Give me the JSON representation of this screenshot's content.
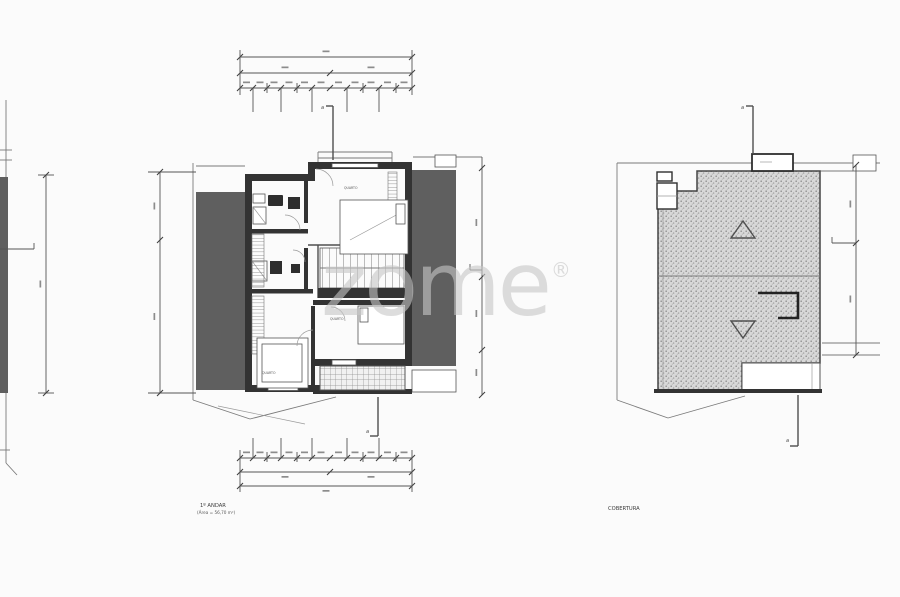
{
  "watermark": {
    "text": "zome",
    "registered": "®",
    "color": "rgba(199,199,199,0.6)"
  },
  "floor_plan": {
    "title": "1º ANDAR",
    "area": "(Área = 56,70 m²)",
    "section_label": "a",
    "rooms": [
      {
        "label": "QUARTO"
      },
      {
        "label": "QUARTO"
      },
      {
        "label": "QUARTO"
      }
    ]
  },
  "roof_plan": {
    "title": "COBERTURA",
    "section_label": "a"
  },
  "colors": {
    "background": "#fbfbfb",
    "neighbor_mass": "#5f5f5f",
    "wall": "#333333",
    "roof_hatch_base": "#d8d8d8",
    "dimension_line": "#555555"
  }
}
